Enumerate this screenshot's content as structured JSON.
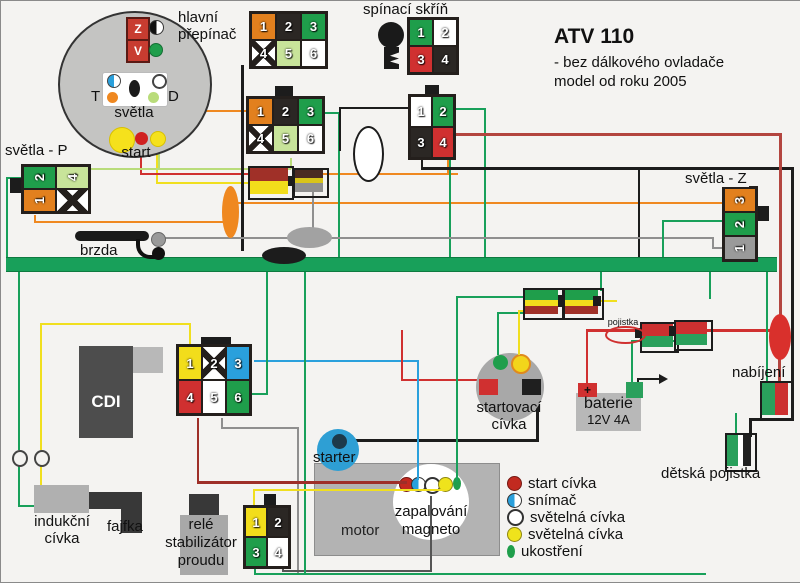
{
  "title": {
    "main": "ATV 110",
    "sub1": "- bez dálkového ovladače",
    "sub2": "model od roku 2005"
  },
  "labels": {
    "hlavni1": "hlavní",
    "hlavni2": "přepínač",
    "spinaci": "spínací skříň",
    "svetla_p": "světla - P",
    "svetla_z": "světla - Z",
    "brzda": "brzda",
    "cdi": "CDI",
    "starter": "starter",
    "motor": "motor",
    "magneto1": "zapalování",
    "magneto2": "magneto",
    "startcoil1": "startovací",
    "startcoil2": "cívka",
    "baterie": "baterie",
    "baterie_spec": "12V 4A",
    "pojistka": "pojistka",
    "nabijeni": "nabíjení",
    "detska": "dětská pojistka",
    "indukcni1": "indukční",
    "indukcni2": "cívka",
    "fajfka": "fajfka",
    "rele1": "relé",
    "rele2": "stabilizátor",
    "rele3": "proudu"
  },
  "pod": {
    "z": "Z",
    "v": "V",
    "t": "T",
    "d": "D",
    "svetla": "světla",
    "start": "start"
  },
  "battery": {
    "plus": "+"
  },
  "wire_colors": {
    "green": "#18a05a",
    "yellow": "#f0df1f",
    "orange": "#ef8820",
    "red": "#d03030",
    "dred": "#9e2f28",
    "wine": "#b3453f",
    "gray": "#8f8f8f",
    "black": "#1c1c1c",
    "blue": "#2aa0dc",
    "lgreen": "#b9dc7a",
    "pink": "#f05ab4",
    "dark": "#555555"
  },
  "connectors": [
    {
      "name": "hlavni-prepinac-conn-1",
      "x": 248,
      "y": 10,
      "cols": 3,
      "cw": 23,
      "ch": 25,
      "pins": [
        {
          "n": "1",
          "c": "orange"
        },
        {
          "n": "2",
          "c": "black"
        },
        {
          "n": "3",
          "c": "green"
        },
        {
          "n": "4",
          "c": "x"
        },
        {
          "n": "5",
          "c": "lgreen"
        },
        {
          "n": "6",
          "c": "white"
        }
      ]
    },
    {
      "name": "hlavni-prepinac-conn-2",
      "x": 245,
      "y": 95,
      "cols": 3,
      "cw": 23,
      "ch": 25,
      "pins": [
        {
          "n": "1",
          "c": "orange"
        },
        {
          "n": "2",
          "c": "black"
        },
        {
          "n": "3",
          "c": "green"
        },
        {
          "n": "4",
          "c": "x"
        },
        {
          "n": "5",
          "c": "lgreen"
        },
        {
          "n": "6",
          "c": "white"
        }
      ]
    },
    {
      "name": "spinaci-skrin-conn-1",
      "x": 406,
      "y": 16,
      "cols": 2,
      "cw": 22,
      "ch": 25,
      "pins": [
        {
          "n": "1",
          "c": "green"
        },
        {
          "n": "2",
          "c": "white"
        },
        {
          "n": "3",
          "c": "red"
        },
        {
          "n": "4",
          "c": "black"
        }
      ]
    },
    {
      "name": "spinaci-skrin-conn-2",
      "x": 407,
      "y": 93,
      "cols": 2,
      "cw": 20,
      "ch": 29,
      "pins": [
        {
          "n": "1",
          "c": "white"
        },
        {
          "n": "2",
          "c": "green"
        },
        {
          "n": "3",
          "c": "black"
        },
        {
          "n": "4",
          "c": "red"
        }
      ]
    },
    {
      "name": "svetla-p-conn",
      "x": 20,
      "y": 163,
      "cols": 2,
      "cw": 31,
      "ch": 21,
      "rot": 1,
      "pins": [
        {
          "n": "2",
          "c": "green"
        },
        {
          "n": "4",
          "c": "lgreen"
        },
        {
          "n": "1",
          "c": "orange"
        },
        {
          "n": "",
          "c": "x"
        }
      ]
    },
    {
      "name": "svetla-z-conn",
      "x": 721,
      "y": 185,
      "cols": 1,
      "cw": 30,
      "ch": 22,
      "rot": 1,
      "pins": [
        {
          "n": "3",
          "c": "orange"
        },
        {
          "n": "2",
          "c": "green"
        },
        {
          "n": "1",
          "c": "gray"
        }
      ]
    },
    {
      "name": "cdi-conn",
      "x": 175,
      "y": 343,
      "cols": 3,
      "cw": 22,
      "ch": 32,
      "pins": [
        {
          "n": "1",
          "c": "yellow"
        },
        {
          "n": "2",
          "c": "x"
        },
        {
          "n": "3",
          "c": "blue"
        },
        {
          "n": "4",
          "c": "red"
        },
        {
          "n": "5",
          "c": "white"
        },
        {
          "n": "6",
          "c": "green"
        }
      ]
    },
    {
      "name": "motor-conn",
      "x": 242,
      "y": 504,
      "cols": 2,
      "cw": 20,
      "ch": 28,
      "pins": [
        {
          "n": "1",
          "c": "yellow"
        },
        {
          "n": "2",
          "c": "black"
        },
        {
          "n": "3",
          "c": "green"
        },
        {
          "n": "4",
          "c": "white"
        }
      ]
    }
  ],
  "wires": [
    [
      "green",
      6,
      176,
      16,
      2
    ],
    [
      "green",
      5,
      176,
      2,
      81
    ],
    [
      "green",
      17,
      268,
      2,
      181
    ],
    [
      "green",
      17,
      462,
      2,
      44
    ],
    [
      "green",
      17,
      504,
      28,
      2
    ],
    [
      "yellow",
      39,
      322,
      151,
      2
    ],
    [
      "yellow",
      39,
      322,
      2,
      127
    ],
    [
      "yellow",
      39,
      462,
      2,
      24
    ],
    [
      "yellow",
      188,
      322,
      2,
      23
    ],
    [
      "yellow",
      155,
      153,
      2,
      30
    ],
    [
      "yellow",
      155,
      181,
      98,
      2
    ],
    [
      "red",
      139,
      153,
      2,
      21
    ],
    [
      "red",
      139,
      172,
      113,
      2
    ],
    [
      "orange",
      317,
      172,
      140,
      2
    ],
    [
      "orange",
      446,
      158,
      2,
      16
    ],
    [
      "orange",
      130,
      109,
      120,
      2
    ],
    [
      "orange",
      122,
      102,
      2,
      7
    ],
    [
      "orange",
      33,
      214,
      2,
      8
    ],
    [
      "orange",
      33,
      220,
      197,
      2
    ],
    [
      "orange",
      232,
      201,
      491,
      2
    ],
    [
      "lgreen",
      88,
      167,
      202,
      2
    ],
    [
      "lgreen",
      289,
      157,
      2,
      11
    ],
    [
      "lgreen",
      157,
      104,
      2,
      64
    ],
    [
      "green",
      321,
      111,
      18,
      2
    ],
    [
      "green",
      337,
      111,
      2,
      146
    ],
    [
      "green",
      455,
      107,
      30,
      2
    ],
    [
      "green",
      483,
      107,
      2,
      150
    ],
    [
      "green",
      448,
      159,
      2,
      98
    ],
    [
      "black",
      338,
      106,
      70,
      2
    ],
    [
      "black",
      338,
      106,
      2,
      44
    ],
    [
      "black",
      420,
      159,
      2,
      9
    ],
    [
      "black",
      420,
      166,
      373,
      3
    ],
    [
      "black",
      790,
      166,
      3,
      254
    ],
    [
      "black",
      748,
      417,
      44,
      3
    ],
    [
      "black",
      748,
      417,
      3,
      19
    ],
    [
      "black",
      637,
      166,
      2,
      91
    ],
    [
      "black",
      240,
      64,
      3,
      186
    ],
    [
      "gray",
      163,
      236,
      550,
      2
    ],
    [
      "gray",
      711,
      236,
      2,
      12
    ],
    [
      "gray",
      711,
      246,
      12,
      2
    ],
    [
      "gray",
      311,
      189,
      2,
      39
    ],
    [
      "wine",
      452,
      132,
      329,
      3
    ],
    [
      "wine",
      778,
      132,
      3,
      184
    ],
    [
      "wine",
      777,
      357,
      3,
      26
    ],
    [
      "dred",
      196,
      417,
      2,
      65
    ],
    [
      "dred",
      196,
      480,
      210,
      3,
      1
    ],
    [
      "yellow",
      252,
      488,
      2,
      18
    ],
    [
      "yellow",
      252,
      488,
      193,
      2,
      1
    ],
    [
      "blue",
      253,
      359,
      165,
      2
    ],
    [
      "blue",
      416,
      359,
      2,
      120,
      1
    ],
    [
      "green",
      251,
      392,
      16,
      2
    ],
    [
      "green",
      265,
      268,
      2,
      126
    ],
    [
      "gray",
      220,
      417,
      2,
      11
    ],
    [
      "gray",
      220,
      426,
      78,
      2
    ],
    [
      "gray",
      296,
      426,
      2,
      146
    ],
    [
      "dark",
      281,
      569,
      150,
      2
    ],
    [
      "dark",
      429,
      495,
      2,
      75,
      1
    ],
    [
      "dark",
      281,
      561,
      2,
      9
    ],
    [
      "green",
      253,
      566,
      2,
      8
    ],
    [
      "green",
      253,
      572,
      452,
      2
    ],
    [
      "green",
      303,
      268,
      2,
      306
    ],
    [
      "green",
      455,
      295,
      72,
      2
    ],
    [
      "green",
      455,
      295,
      2,
      186,
      1
    ],
    [
      "green",
      496,
      311,
      36,
      2
    ],
    [
      "green",
      496,
      311,
      2,
      43,
      1
    ],
    [
      "yellow",
      517,
      309,
      14,
      2
    ],
    [
      "yellow",
      517,
      309,
      2,
      45,
      1
    ],
    [
      "yellow",
      594,
      299,
      22,
      2
    ],
    [
      "green",
      599,
      268,
      2,
      22
    ],
    [
      "green",
      630,
      339,
      46,
      2
    ],
    [
      "green",
      630,
      339,
      2,
      44
    ],
    [
      "red",
      585,
      328,
      195,
      3
    ],
    [
      "red",
      585,
      328,
      2,
      56
    ],
    [
      "red",
      400,
      378,
      80,
      2
    ],
    [
      "red",
      400,
      329,
      2,
      51
    ],
    [
      "green",
      661,
      219,
      62,
      2
    ],
    [
      "green",
      661,
      219,
      2,
      39
    ],
    [
      "green",
      708,
      268,
      2,
      30
    ],
    [
      "green",
      765,
      268,
      2,
      115
    ],
    [
      "green",
      734,
      412,
      2,
      22
    ],
    [
      "pink",
      113,
      77,
      44,
      2
    ],
    [
      "black",
      345,
      438,
      193,
      3
    ],
    [
      "black",
      535,
      394,
      3,
      46
    ]
  ],
  "shapes": [
    {
      "n": "svetla-p-tab",
      "x": 9,
      "y": 177,
      "w": 11,
      "h": 15,
      "f": "#1c1c1c"
    },
    {
      "n": "svetla-z-tab",
      "x": 757,
      "y": 205,
      "w": 11,
      "h": 15,
      "f": "#1c1c1c"
    },
    {
      "n": "conn-b-tab",
      "x": 274,
      "y": 85,
      "w": 18,
      "h": 10,
      "f": "#1c1c1c"
    },
    {
      "n": "conn-c-tab",
      "x": 424,
      "y": 84,
      "w": 14,
      "h": 9,
      "f": "#1c1c1c"
    },
    {
      "n": "conn-d-tab",
      "x": 200,
      "y": 336,
      "w": 30,
      "h": 9,
      "f": "#1c1c1c"
    },
    {
      "n": "conn-e-tab",
      "x": 263,
      "y": 493,
      "w": 12,
      "h": 12,
      "f": "#1c1c1c"
    },
    {
      "n": "turn-indicator-ellipse",
      "x": 221,
      "y": 185,
      "w": 17,
      "h": 52,
      "f": "#ef8820",
      "br": 50
    },
    {
      "n": "lens-ellipse",
      "x": 352,
      "y": 125,
      "w": 27,
      "h": 52,
      "f": "#ffffff",
      "bd": "2px solid #1c1c1c",
      "br": 50
    },
    {
      "n": "tail-light-gray-ellipse",
      "x": 286,
      "y": 226,
      "w": 45,
      "h": 21,
      "f": "#a2a2a2",
      "br": 50
    },
    {
      "n": "tail-light-black-ellipse",
      "x": 261,
      "y": 246,
      "w": 44,
      "h": 17,
      "f": "#1c1c1c",
      "br": 50
    },
    {
      "n": "inline-conn-left-red",
      "x": 249,
      "y": 167,
      "w": 38,
      "h": 13,
      "f": "#a03028"
    },
    {
      "n": "inline-conn-left-yellow",
      "x": 249,
      "y": 180,
      "w": 38,
      "h": 13,
      "f": "#f2dd1b"
    },
    {
      "n": "inline-conn-left-border",
      "x": 247,
      "y": 165,
      "w": 42,
      "h": 30,
      "bd": "2px solid #1c1c1c"
    },
    {
      "n": "inline-conn-left-tab",
      "x": 287,
      "y": 175,
      "w": 7,
      "h": 10,
      "f": "#1c1c1c"
    },
    {
      "n": "inline-conn-right-top",
      "x": 294,
      "y": 169,
      "w": 28,
      "h": 8,
      "f": "#4a2a22"
    },
    {
      "n": "inline-conn-right-yellow",
      "x": 294,
      "y": 177,
      "w": 28,
      "h": 5,
      "f": "#d8c41a"
    },
    {
      "n": "inline-conn-right-gray",
      "x": 294,
      "y": 182,
      "w": 28,
      "h": 9,
      "f": "#8f8f8f"
    },
    {
      "n": "inline-conn-right-border",
      "x": 292,
      "y": 167,
      "w": 32,
      "h": 26,
      "bd": "2px solid #1c1c1c"
    },
    {
      "n": "striped-conn-left-green",
      "x": 524,
      "y": 289,
      "w": 33,
      "h": 10,
      "f": "#1f9e4b"
    },
    {
      "n": "striped-conn-left-yellow",
      "x": 524,
      "y": 299,
      "w": 33,
      "h": 6,
      "f": "#f2dd1b"
    },
    {
      "n": "striped-conn-left-red",
      "x": 524,
      "y": 305,
      "w": 33,
      "h": 8,
      "f": "#a03028"
    },
    {
      "n": "striped-conn-left-border",
      "x": 522,
      "y": 287,
      "w": 37,
      "h": 28,
      "bd": "2px solid #1c1c1c"
    },
    {
      "n": "striped-conn-tab",
      "x": 557,
      "y": 294,
      "w": 8,
      "h": 12,
      "f": "#1c1c1c"
    },
    {
      "n": "striped-conn-right-green",
      "x": 564,
      "y": 289,
      "w": 33,
      "h": 10,
      "f": "#1f9e4b"
    },
    {
      "n": "striped-conn-right-yellow",
      "x": 564,
      "y": 299,
      "w": 33,
      "h": 6,
      "f": "#f2dd1b"
    },
    {
      "n": "striped-conn-right-red",
      "x": 564,
      "y": 305,
      "w": 33,
      "h": 8,
      "f": "#a03028"
    },
    {
      "n": "striped-conn-right-border",
      "x": 562,
      "y": 287,
      "w": 37,
      "h": 28,
      "bd": "2px solid #1c1c1c"
    },
    {
      "n": "striped-conn-right-dot",
      "x": 592,
      "y": 295,
      "w": 8,
      "h": 10,
      "f": "#1c1c1c"
    },
    {
      "n": "rg-conn-1-red",
      "x": 641,
      "y": 323,
      "w": 31,
      "h": 12,
      "f": "#cc3030"
    },
    {
      "n": "rg-conn-1-green",
      "x": 641,
      "y": 335,
      "w": 31,
      "h": 11,
      "f": "#2aa05c"
    },
    {
      "n": "rg-conn-1-border",
      "x": 639,
      "y": 321,
      "w": 35,
      "h": 27,
      "bd": "2px solid #1c1c1c"
    },
    {
      "n": "rg-conn-1-tab",
      "x": 634,
      "y": 327,
      "w": 7,
      "h": 10,
      "f": "#1c1c1c"
    },
    {
      "n": "rg-conn-2-red",
      "x": 675,
      "y": 321,
      "w": 31,
      "h": 12,
      "f": "#cc3030"
    },
    {
      "n": "rg-conn-2-green",
      "x": 675,
      "y": 333,
      "w": 31,
      "h": 11,
      "f": "#2aa05c"
    },
    {
      "n": "rg-conn-2-border",
      "x": 673,
      "y": 319,
      "w": 35,
      "h": 27,
      "bd": "2px solid #1c1c1c"
    },
    {
      "n": "rg-conn-2-tab",
      "x": 668,
      "y": 325,
      "w": 7,
      "h": 10,
      "f": "#1c1c1c"
    },
    {
      "n": "fuse-ellipse",
      "x": 604,
      "y": 325,
      "w": 37,
      "h": 14,
      "bd": "2px solid #d03030",
      "br": 50
    },
    {
      "n": "charging-ellipse",
      "x": 768,
      "y": 313,
      "w": 22,
      "h": 46,
      "f": "#d9302c",
      "br": 50
    },
    {
      "n": "charging-conn-green",
      "x": 761,
      "y": 382,
      "w": 13,
      "h": 32,
      "f": "#2aa05c"
    },
    {
      "n": "charging-conn-red",
      "x": 774,
      "y": 382,
      "w": 13,
      "h": 32,
      "f": "#cc3030"
    },
    {
      "n": "charging-conn-border",
      "x": 759,
      "y": 380,
      "w": 30,
      "h": 36,
      "bd": "2px solid #1c1c1c"
    },
    {
      "n": "child-fuse-green",
      "x": 726,
      "y": 434,
      "w": 11,
      "h": 31,
      "f": "#2aa05c"
    },
    {
      "n": "child-fuse-white",
      "x": 737,
      "y": 434,
      "w": 5,
      "h": 31,
      "f": "#ffffff"
    },
    {
      "n": "child-fuse-black",
      "x": 742,
      "y": 434,
      "w": 8,
      "h": 31,
      "f": "#222222"
    },
    {
      "n": "child-fuse-border",
      "x": 724,
      "y": 432,
      "w": 28,
      "h": 35,
      "bd": "2px solid #1c1c1c"
    },
    {
      "n": "coil-symbol-ring-1",
      "x": 11,
      "y": 449,
      "w": 12,
      "h": 13,
      "f": "#f4f3f1",
      "bd": "2px solid #444",
      "br": 50
    },
    {
      "n": "coil-symbol-ring-2",
      "x": 33,
      "y": 449,
      "w": 12,
      "h": 13,
      "f": "#f4f3f1",
      "bd": "2px solid #444",
      "br": 50
    },
    {
      "n": "battery-arrow-line",
      "x": 636,
      "y": 377,
      "w": 24,
      "h": 2,
      "f": "#1c1c1c"
    },
    {
      "n": "battery-arrow-stub",
      "x": 636,
      "y": 377,
      "w": 2,
      "h": 8,
      "f": "#1c1c1c"
    }
  ],
  "magneto_dots": {
    "y": 476,
    "items": [
      {
        "t": "dot",
        "c": "#c22a20",
        "x": 398
      },
      {
        "t": "half",
        "c": "#2aa0dc",
        "x": 410
      },
      {
        "t": "ring",
        "c": "#ffffff",
        "x": 423
      },
      {
        "t": "dot",
        "c": "#efe31c",
        "x": 437
      },
      {
        "t": "oval",
        "c": "#1f9e4b",
        "x": 452
      }
    ]
  },
  "legend": {
    "items": [
      {
        "t": "dot",
        "c": "#c22a20",
        "label": "start cívka"
      },
      {
        "t": "half",
        "c": "#2aa0dc",
        "label": "snímač"
      },
      {
        "t": "ring",
        "c": "#ffffff",
        "label": "světelná cívka"
      },
      {
        "t": "dot",
        "c": "#efe31c",
        "label": "světelná cívka"
      },
      {
        "t": "oval",
        "c": "#1f9e4b",
        "label": "ukostření"
      }
    ]
  }
}
